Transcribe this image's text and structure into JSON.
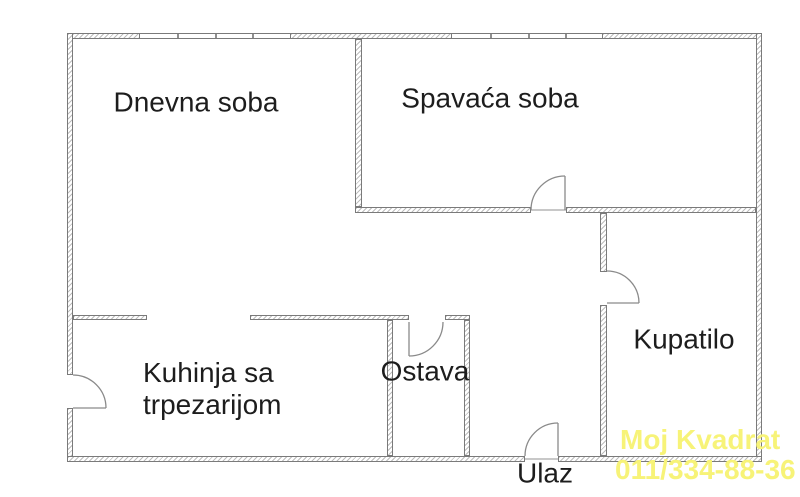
{
  "floorplan": {
    "rooms": {
      "dnevna": {
        "label": "Dnevna soba"
      },
      "spavaca": {
        "label": "Spavaća soba"
      },
      "kuhinja": {
        "label_line1": "Kuhinja sa",
        "label_line2": "trpezarijom"
      },
      "ostava": {
        "label": "Ostava"
      },
      "kupatilo": {
        "label": "Kupatilo"
      },
      "ulaz": {
        "label": "Ulaz"
      }
    },
    "watermark": {
      "line1": "Moj Kvadrat",
      "line2": "011/334-88-36",
      "color": "#f7f378"
    },
    "style": {
      "background": "#ffffff",
      "wall_outline": "#7a7a7a",
      "wall_hatch": "#bdbdbd",
      "label_color": "#1d1d1d"
    }
  }
}
